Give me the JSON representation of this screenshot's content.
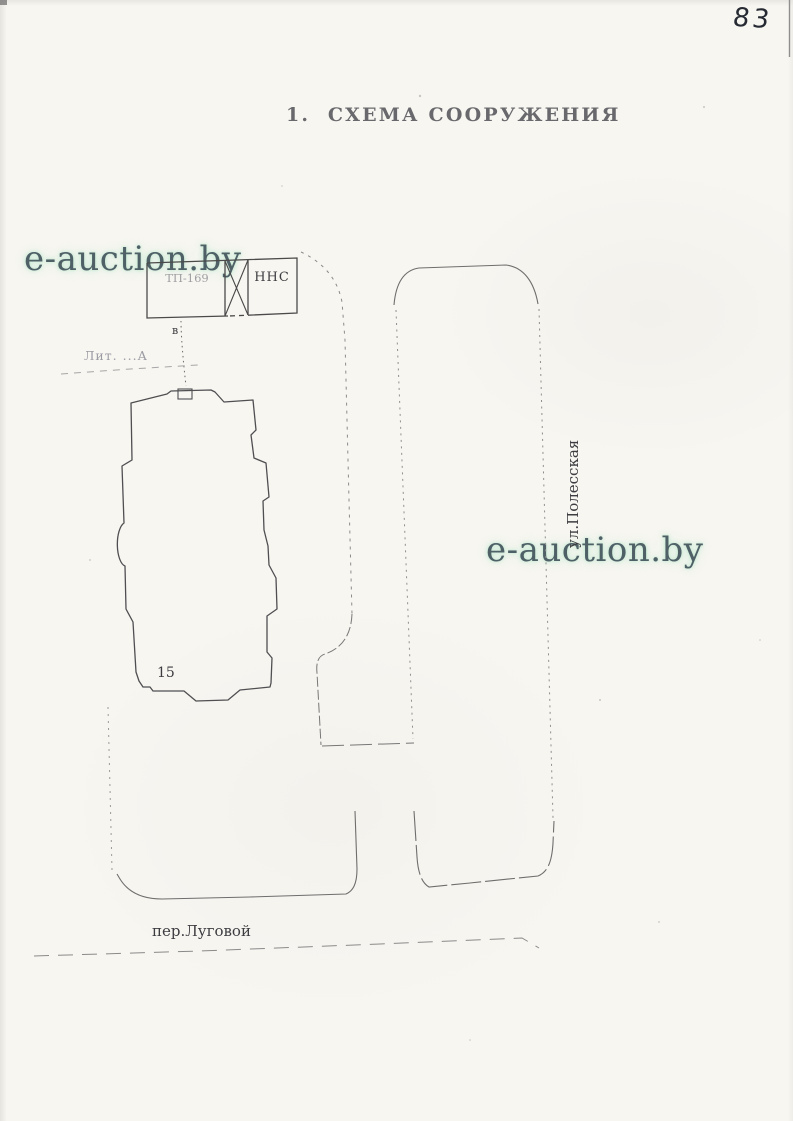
{
  "page": {
    "number": "83",
    "title": "1.  СХЕМА СООРУЖЕНИЯ"
  },
  "watermark": {
    "text": "e-auction.by",
    "text_color": "#41545c",
    "glow_color": "#b8e6cc"
  },
  "plan": {
    "utility_block": {
      "left_box_label": "ТП-169",
      "right_box_label": "ННС"
    },
    "connection_label": "в",
    "building": {
      "number": "15",
      "liter_label": "Лит. ...А"
    },
    "streets": {
      "side_street": "ул.Полесская",
      "bottom_street": "пер.Луговой"
    },
    "ink_color": "#4a4a4a"
  }
}
